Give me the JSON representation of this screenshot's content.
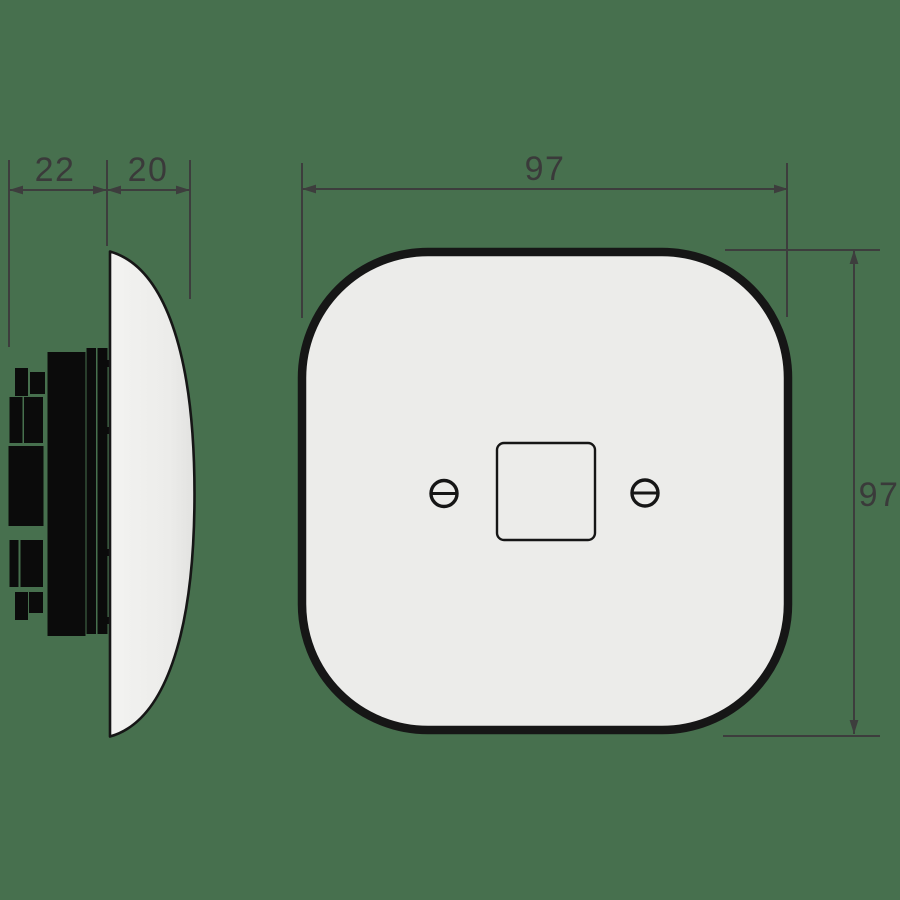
{
  "page": {
    "background_color": "#47704e",
    "dimension_color": "#3d3d3d",
    "outline_color": "#161616",
    "ceramic_fill": "#ececea",
    "mechanism_fill": "#0b0b0b"
  },
  "views": {
    "side_view_name": "side-profile-view",
    "front_view_name": "front-view"
  },
  "dimensions": {
    "mechanism_depth": "22",
    "cover_depth": "20",
    "plate_width": "97",
    "plate_height": "97"
  }
}
